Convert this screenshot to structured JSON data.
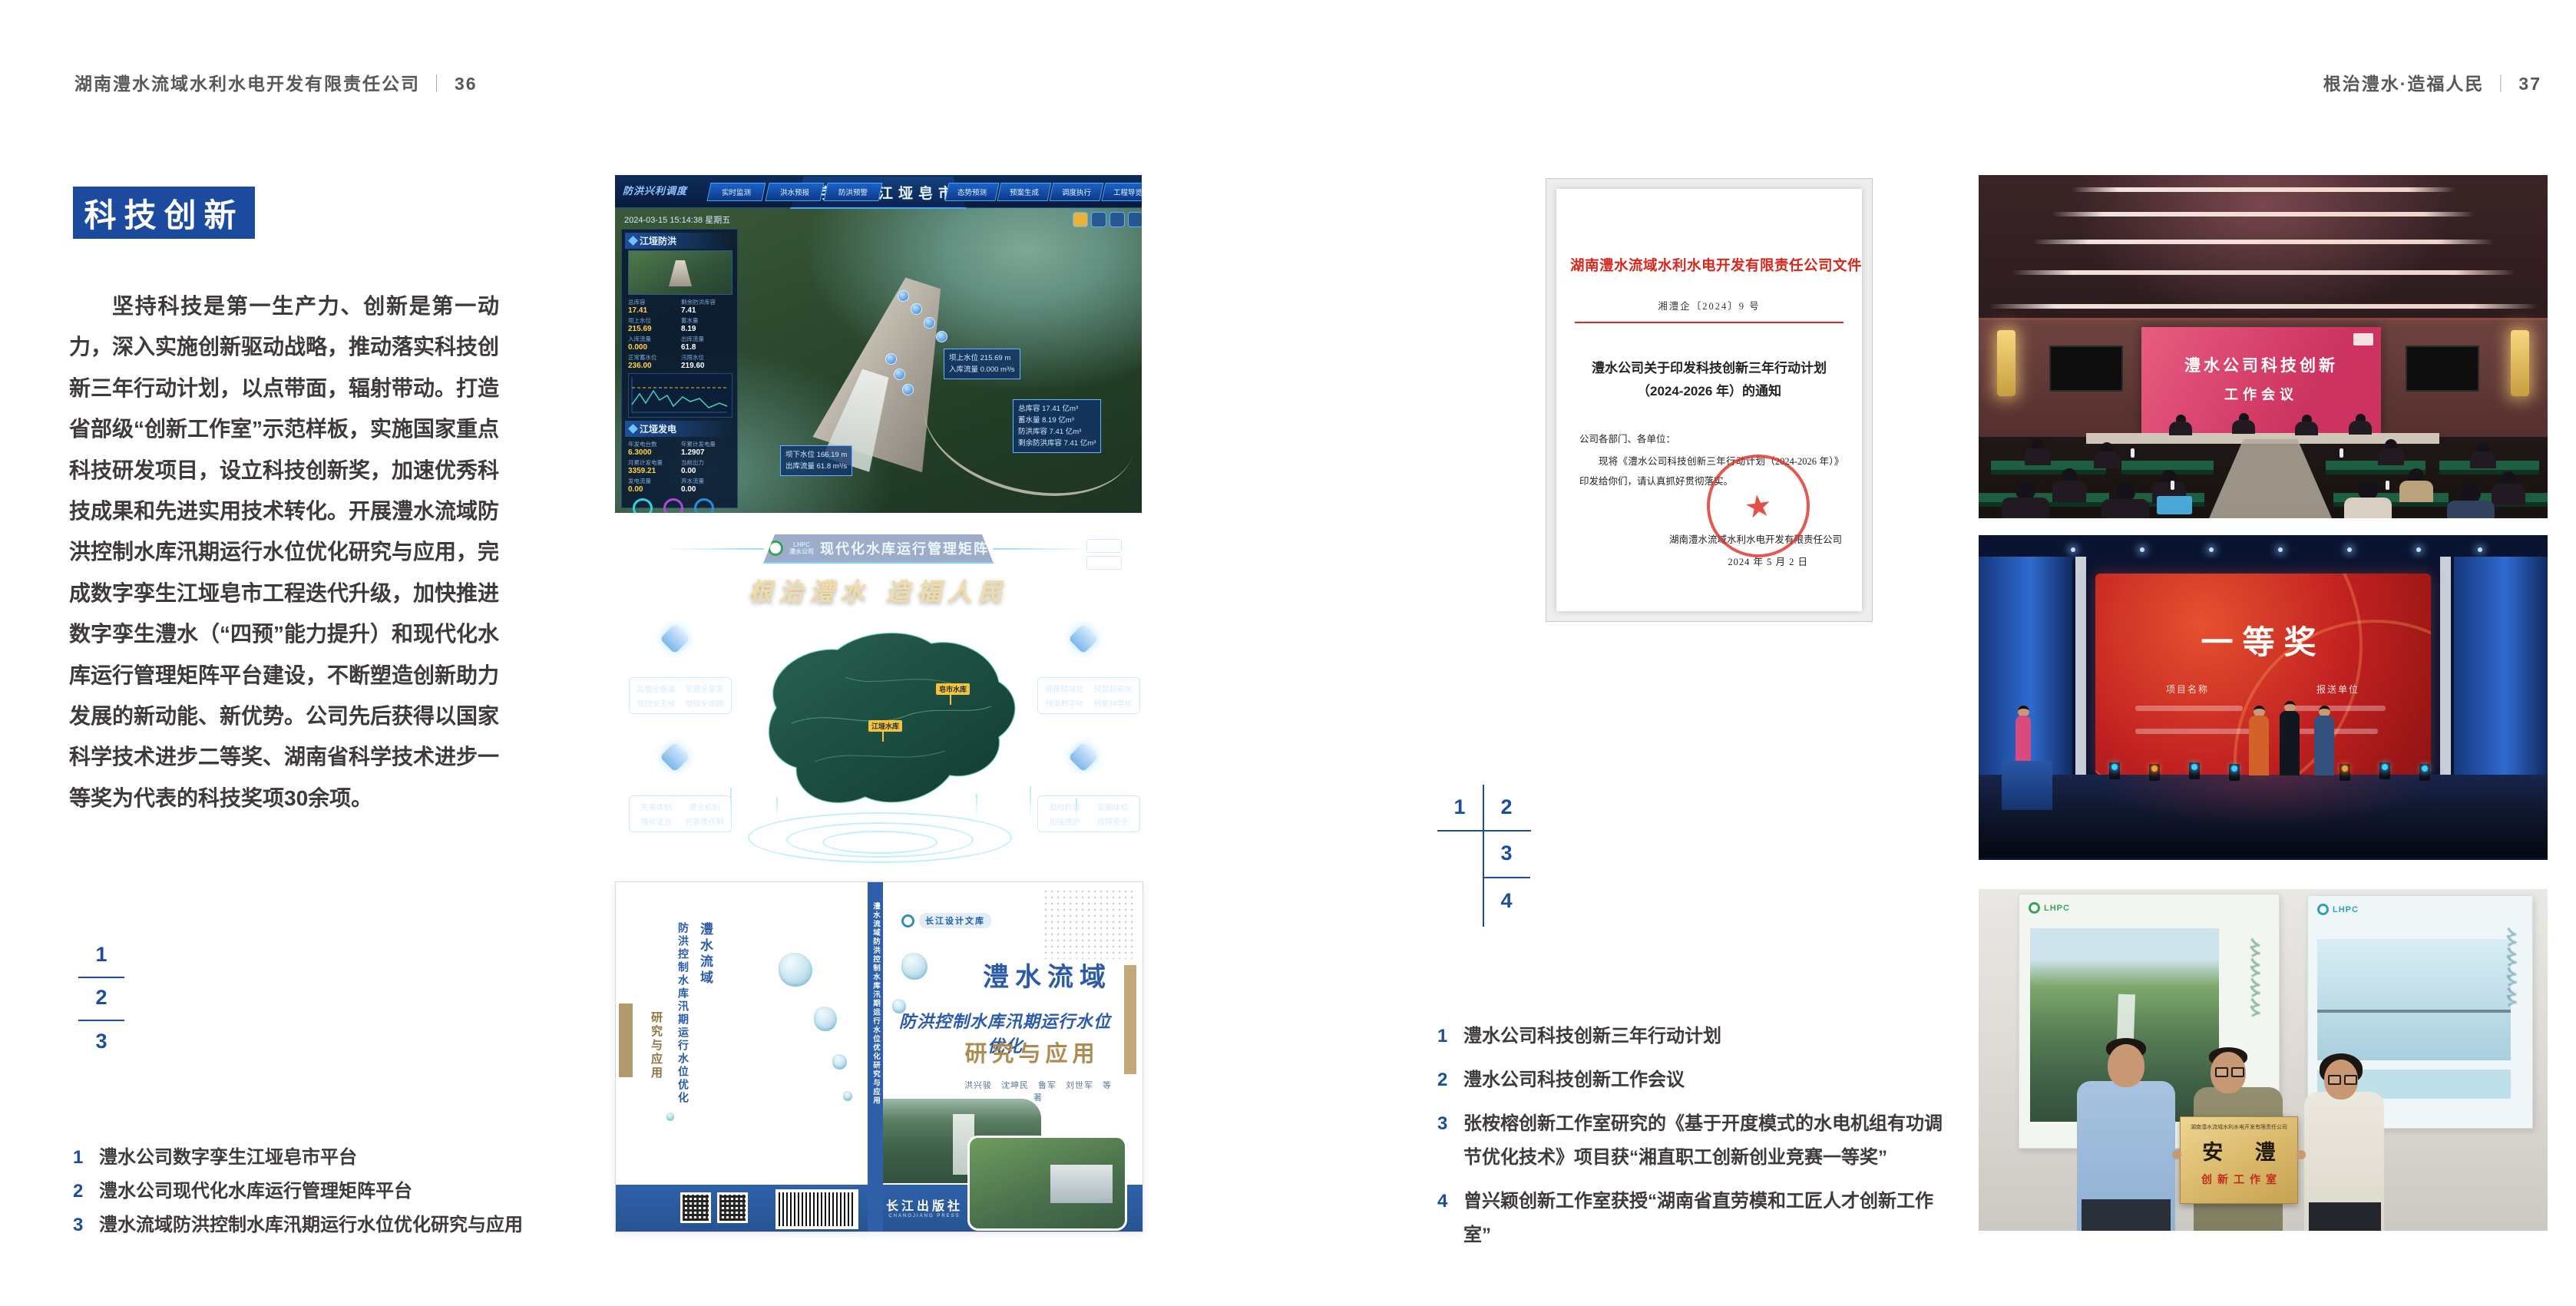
{
  "colors": {
    "accent_blue": "#1b4a9e",
    "caption_blue": "#1d4e9e",
    "doc_red": "#d9261c",
    "text_dark": "#3e3a39",
    "header_gray": "#595757"
  },
  "page_left": {
    "header": {
      "title": "湖南澧水流域水利水电开发有限责任公司",
      "separator": "｜",
      "page_number": "36"
    },
    "section_title": "科技创新",
    "body_paragraph": "坚持科技是第一生产力、创新是第一动力，深入实施创新驱动战略，推动落实科技创新三年行动计划，以点带面，辐射带动。打造省部级“创新工作室”示范样板，实施国家重点科技研发项目，设立科技创新奖，加速优秀科技成果和先进实用技术转化。开展澧水流域防洪控制水库汛期运行水位优化研究与应用，完成数字孪生江垭皂市工程迭代升级，加快推进数字孪生澧水（“四预”能力提升）和现代化水库运行管理矩阵平台建设，不断塑造创新助力发展的新动能、新优势。公司先后获得以国家科学技术进步二等奖、湖南省科学技术进步一等奖为代表的科技奖项30余项。",
    "figure_markers": [
      "1",
      "2",
      "3"
    ],
    "captions": [
      {
        "num": "1",
        "text": "澧水公司数字孪生江垭皂市平台"
      },
      {
        "num": "2",
        "text": "澧水公司现代化水库运行管理矩阵平台"
      },
      {
        "num": "3",
        "text": "澧水流域防洪控制水库汛期运行水位优化研究与应用"
      }
    ]
  },
  "page_right": {
    "header": {
      "title": "根治澧水·造福人民",
      "separator": "｜",
      "page_number": "37"
    },
    "figure_markers": [
      "1",
      "2",
      "3",
      "4"
    ],
    "captions": [
      {
        "num": "1",
        "text": "澧水公司科技创新三年行动计划"
      },
      {
        "num": "2",
        "text": "澧水公司科技创新工作会议"
      },
      {
        "num": "3",
        "text": "张桉榕创新工作室研究的《基于开度模式的水电机组有功调节优化技术》项目获“湘直职工创新创业竞赛一等奖”"
      },
      {
        "num": "4",
        "text": "曾兴颖创新工作室获授“湖南省直劳模和工匠人才创新工作室”"
      }
    ]
  },
  "figures": {
    "dashboard": {
      "corner_label": "防洪兴利调度",
      "title": "数字孪生江垭皂市",
      "tabs_left": [
        "实时监测",
        "洪水预报",
        "防洪预警"
      ],
      "tabs_right": [
        "态势预测",
        "预案生成",
        "调度执行",
        "工程导览"
      ],
      "datetime": "2024-03-15 15:14:38 星期五",
      "panel_flood": {
        "title": "江垭防洪",
        "rows": [
          {
            "label": "总库容",
            "value": "17.41"
          },
          {
            "label": "剩余防洪库容",
            "value": "7.41"
          },
          {
            "label": "坝上水位",
            "value": "215.69"
          },
          {
            "label": "蓄水量",
            "value": "8.19"
          },
          {
            "label": "入库流量",
            "value": "0.000"
          },
          {
            "label": "出库流量",
            "value": "61.8"
          },
          {
            "label": "正常蓄水位",
            "value": "236.00"
          },
          {
            "label": "汛限水位",
            "value": "219.60"
          }
        ]
      },
      "panel_power": {
        "title": "江垭发电",
        "rows": [
          {
            "label": "年发电台数",
            "value": "6.3000"
          },
          {
            "label": "年累计发电量",
            "value": "1.2907"
          },
          {
            "label": "月累计发电量",
            "value": "3359.21"
          },
          {
            "label": "当前出力",
            "value": "0.00"
          },
          {
            "label": "发电流量",
            "value": "0.00"
          },
          {
            "label": "弃水流量",
            "value": "0.00"
          }
        ]
      },
      "callout_up": {
        "rows": [
          "坝上水位 215.69 m",
          "入库流量 0.000 m³/s"
        ]
      },
      "callout_storage": {
        "rows": [
          "总库容 17.41 亿m³",
          "蓄水量 8.19 亿m³",
          "防洪库容 7.41 亿m³",
          "剩余防洪库容 7.41 亿m³"
        ]
      },
      "callout_down": {
        "rows": [
          "坝下水位 166.19 m",
          "出库流量 61.8 m³/s"
        ]
      }
    },
    "platform": {
      "logo_abbr": "LHPC",
      "logo_name": "澧水公司",
      "title": "现代化水库运行管理矩阵",
      "slogan": "根治澧水 造福人民",
      "panels": [
        {
          "name": "四全",
          "items": [
            "监管全覆盖",
            "掌握全要素",
            "管控全天候",
            "管理全周期"
          ]
        },
        {
          "name": "四预",
          "items": [
            "预报精准化",
            "预警超前化",
            "预演数字化",
            "预案科学化"
          ]
        },
        {
          "name": "四制",
          "items": [
            "完善体制",
            "健全机制",
            "强化法治",
            "完善责任制"
          ]
        },
        {
          "name": "四管",
          "items": [
            "及时检验",
            "定期体检",
            "加强维护",
            "保障安全"
          ]
        }
      ],
      "map_markers": [
        "皂市水库",
        "江垭水库"
      ]
    },
    "book": {
      "series_badge": "长江设计文库",
      "title_main": "澧水流域",
      "title_sub": "防洪控制水库汛期运行水位优化",
      "title_tail": "研究与应用",
      "authors": "洪兴骏　沈坤民　鲁军　刘世军　等著",
      "spine_text": "澧水流域防洪控制水库汛期运行水位优化研究与应用",
      "back_title_1": "澧水流域",
      "back_title_2": "防洪控制水库汛期运行水位优化",
      "back_title_3": "研究与应用",
      "publisher": "长江出版社",
      "publisher_en": "CHANGJIANG PRESS"
    },
    "document": {
      "title_header": "湖南澧水流域水利水电开发有限责任公司文件",
      "doc_number": "湘澧企〔2024〕9 号",
      "subject_line1": "澧水公司关于印发科技创新三年行动计划",
      "subject_line2": "（2024-2026 年）的通知",
      "salutation": "公司各部门、各单位：",
      "body": "现将《澧水公司科技创新三年行动计划（2024-2026 年）》印发给你们，请认真抓好贯彻落实。",
      "signature": "湖南澧水流域水利水电开发有限责任公司",
      "date": "2024 年 5 月 2 日",
      "seal_star": "★"
    },
    "meeting": {
      "screen_line1": "澧水公司科技创新",
      "screen_line2": "工作会议"
    },
    "award": {
      "screen_title": "一等奖",
      "column1": "项目名称",
      "column2": "报送单位"
    },
    "plaque": {
      "org_line": "湖南澧水流域水利水电开发有限责任公司",
      "name": "安 澧",
      "subtitle": "创新工作室",
      "poster_logo": "LHPC"
    }
  }
}
